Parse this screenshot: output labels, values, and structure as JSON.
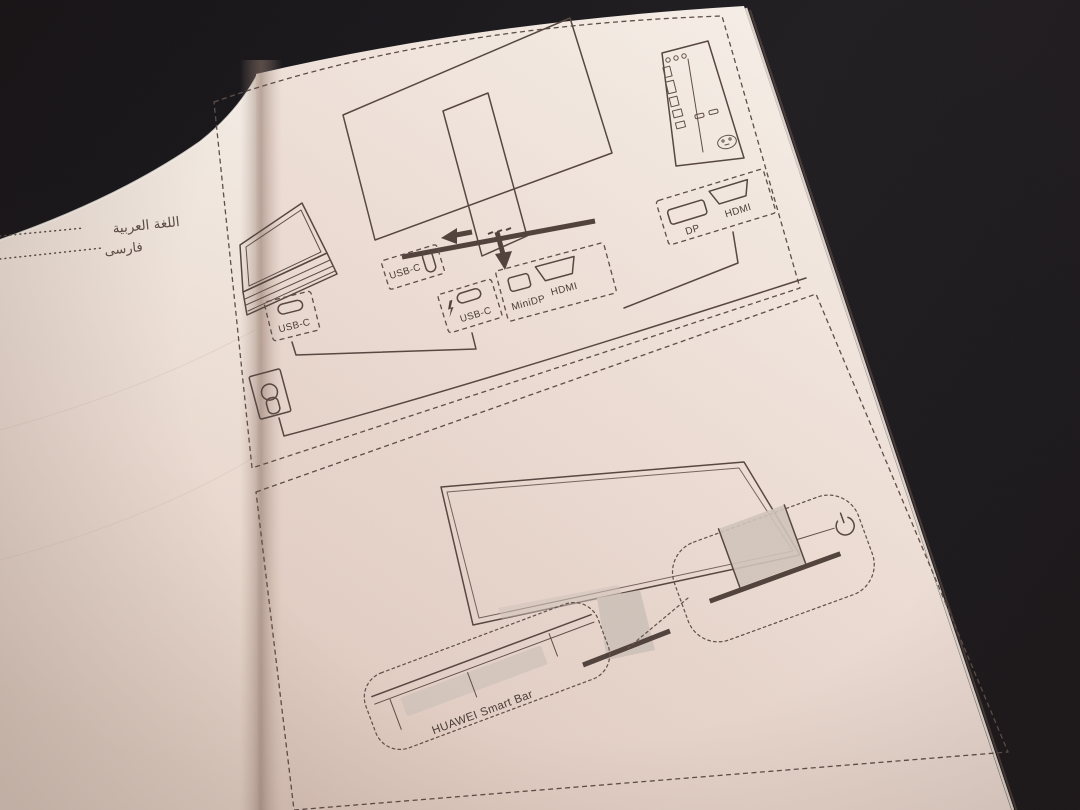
{
  "left_page": {
    "toc": [
      {
        "label": "اللغة العربية"
      },
      {
        "label": "فارسی"
      }
    ]
  },
  "right_page": {
    "connection_diagram": {
      "laptop_port_label": "USB-C",
      "monitor_rear_port_label": "USB-C",
      "monitor_input_usbc_label": "USB-C",
      "monitor_input_minidp_label": "MiniDP",
      "monitor_input_hdmi_label": "HDMI",
      "pc_dp_label": "DP",
      "pc_hdmi_label": "HDMI"
    },
    "smartbar_diagram": {
      "smart_bar_label": "HUAWEI Smart Bar"
    }
  },
  "icons": {
    "lightning": "fast-charge-lightning",
    "power": "power-symbol",
    "plug": "power-plug",
    "port_shapes": [
      "usb-c",
      "minidp",
      "hdmi",
      "dp"
    ]
  },
  "colors": {
    "background": "#1b181b",
    "paper_light": "#f5eee7",
    "paper_shadow": "#d9c3b8",
    "ink": "#564640"
  }
}
